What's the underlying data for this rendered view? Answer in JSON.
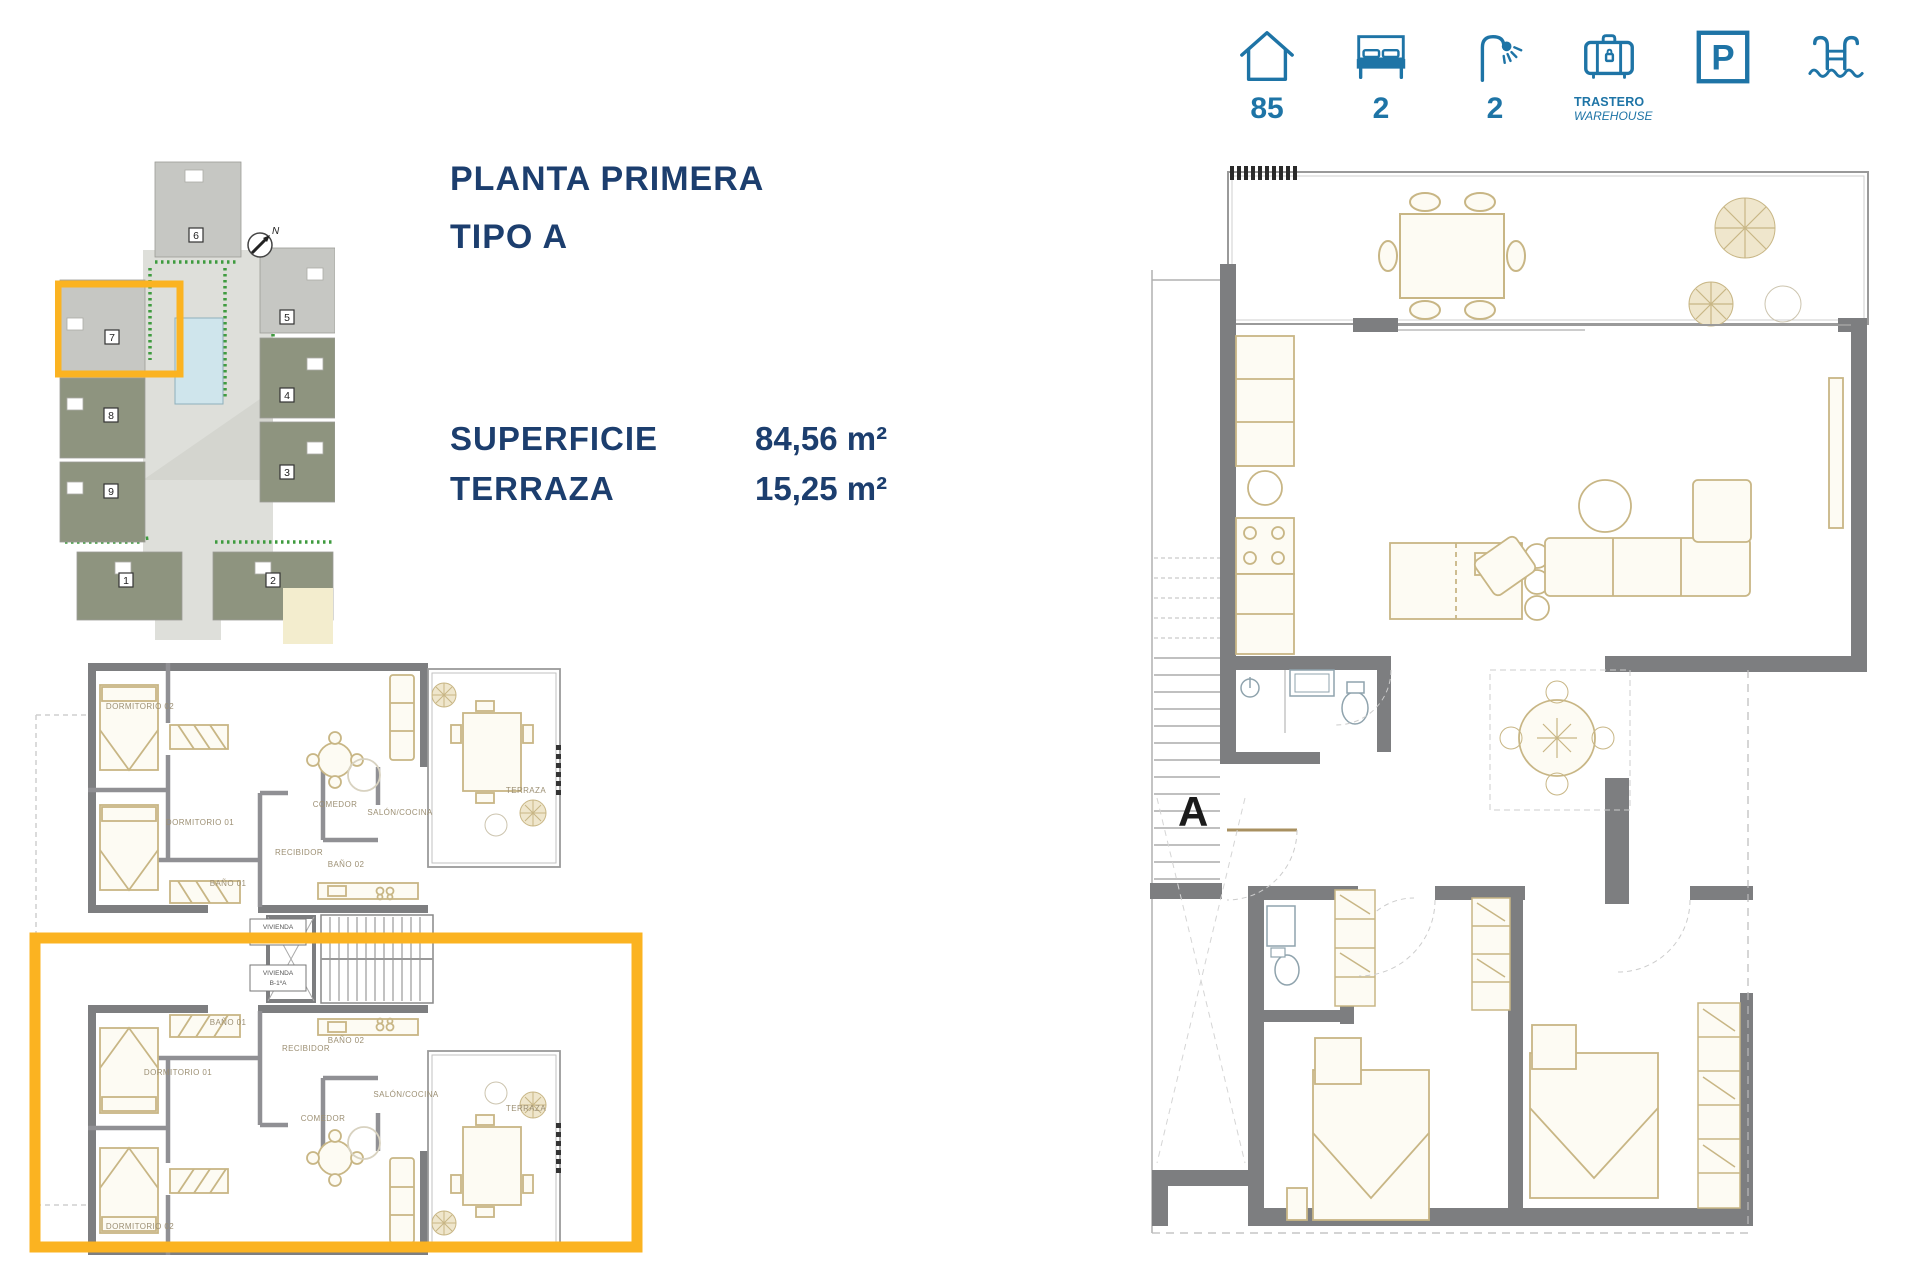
{
  "features": {
    "area": {
      "icon": "house-icon",
      "value": "85"
    },
    "bedrooms": {
      "icon": "bed-icon",
      "value": "2"
    },
    "bathrooms": {
      "icon": "shower-icon",
      "value": "2"
    },
    "storage": {
      "icon": "warehouse-icon",
      "label": "TRASTERO",
      "label_en": "WAREHOUSE"
    },
    "parking": {
      "icon": "parking-icon",
      "letter": "P"
    },
    "pool": {
      "icon": "pool-icon"
    }
  },
  "info": {
    "title": "PLANTA PRIMERA",
    "subtitle": "TIPO A",
    "rows": [
      {
        "label": "SUPERFICIE",
        "value": "84,56 m²"
      },
      {
        "label": "TERRAZA",
        "value": "15,25 m²"
      }
    ]
  },
  "site_plan": {
    "compass": "N",
    "buildings": {
      "b1": "1",
      "b2": "2",
      "b3": "3",
      "b4": "4",
      "b5": "5",
      "b6": "6",
      "b7": "7",
      "b8": "8",
      "b9": "9"
    }
  },
  "floor_plan_small": {
    "rooms": {
      "dormitorio_02": "DORMITORIO 02",
      "dormitorio_01": "DORMITORIO 01",
      "bano_01": "BAÑO 01",
      "bano_02": "BAÑO 02",
      "recibidor": "RECIBIDOR",
      "comedor": "COMEDOR",
      "salon_cocina": "SALÓN/COCINA",
      "terraza": "TERRAZA"
    },
    "core_labels": {
      "vivienda_top_line1": "VIVIENDA",
      "vivienda_top_line2": "B-1ºB",
      "vivienda_bottom_line1": "VIVIENDA",
      "vivienda_bottom_line2": "B-1ºA"
    }
  },
  "floor_plan_large": {
    "unit_label": "A"
  },
  "colors": {
    "accent_yellow": "#FBB321",
    "icon_blue": "#1E74A6",
    "title_navy": "#1C3E6E",
    "wall_gray": "#7D7E80",
    "furniture_tan": "#C8B685",
    "pool_blue": "#CFE5EC",
    "building_olive": "#8E947F",
    "building_light": "#C6C7C3",
    "hedge_green": "#3F9B3F"
  }
}
